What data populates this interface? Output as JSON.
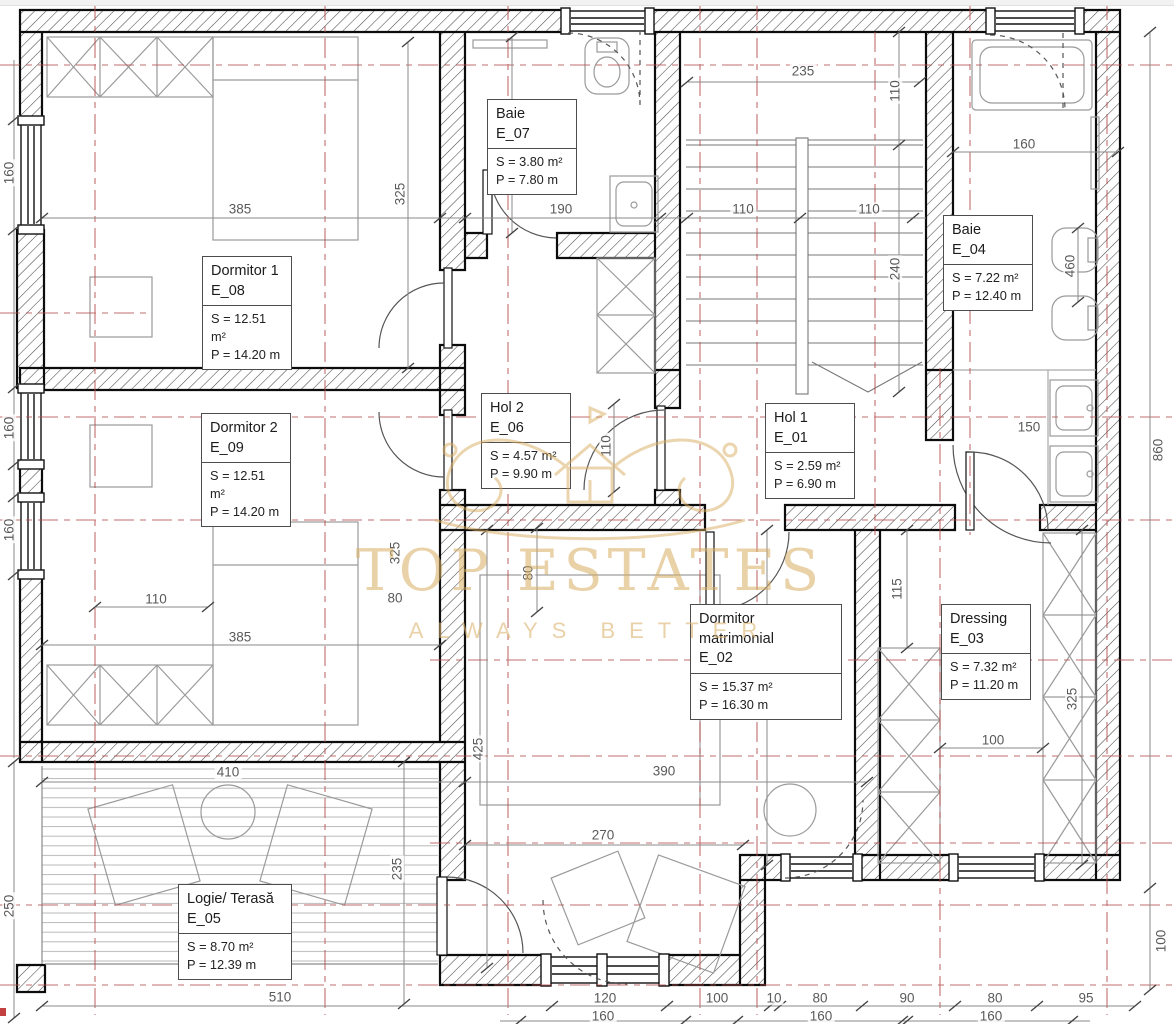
{
  "watermark": {
    "title": "TOP ESTATES",
    "subtitle": "ALWAYS BETTER"
  },
  "colors": {
    "axis_red": "#b34b4b",
    "watermark_gold": "#d8ad62",
    "wall_black": "#111111"
  },
  "rooms": [
    {
      "name": "Baie",
      "code": "E_07",
      "area": "S = 3.80 m²",
      "perimeter": "P = 7.80 m"
    },
    {
      "name": "Dormitor 1",
      "code": "E_08",
      "area": "S = 12.51 m²",
      "perimeter": "P = 14.20 m"
    },
    {
      "name": "Dormitor 2",
      "code": "E_09",
      "area": "S = 12.51 m²",
      "perimeter": "P = 14.20 m"
    },
    {
      "name": "Hol 2",
      "code": "E_06",
      "area": "S = 4.57 m²",
      "perimeter": "P = 9.90 m"
    },
    {
      "name": "Hol 1",
      "code": "E_01",
      "area": "S = 2.59 m²",
      "perimeter": "P = 6.90 m"
    },
    {
      "name": "Baie",
      "code": "E_04",
      "area": "S = 7.22 m²",
      "perimeter": "P = 12.40 m"
    },
    {
      "name": "Dormitor matrimonial",
      "code": "E_02",
      "area": "S = 15.37 m²",
      "perimeter": "P = 16.30 m"
    },
    {
      "name": "Dressing",
      "code": "E_03",
      "area": "S = 7.32 m²",
      "perimeter": "P = 11.20 m"
    },
    {
      "name": "Logie/ Terasă",
      "code": "E_05",
      "area": "S = 8.70 m²",
      "perimeter": "P = 12.39 m"
    }
  ],
  "dims": [
    "385",
    "325",
    "200",
    "190",
    "235",
    "110",
    "110",
    "110",
    "240",
    "160",
    "460",
    "160",
    "160",
    "160",
    "110",
    "150",
    "860",
    "110",
    "80",
    "325",
    "385",
    "80",
    "115",
    "325",
    "325",
    "100",
    "425",
    "390",
    "270",
    "410",
    "235",
    "250",
    "510",
    "120",
    "100",
    "10",
    "80",
    "90",
    "80",
    "95",
    "160",
    "160",
    "160",
    "100"
  ]
}
